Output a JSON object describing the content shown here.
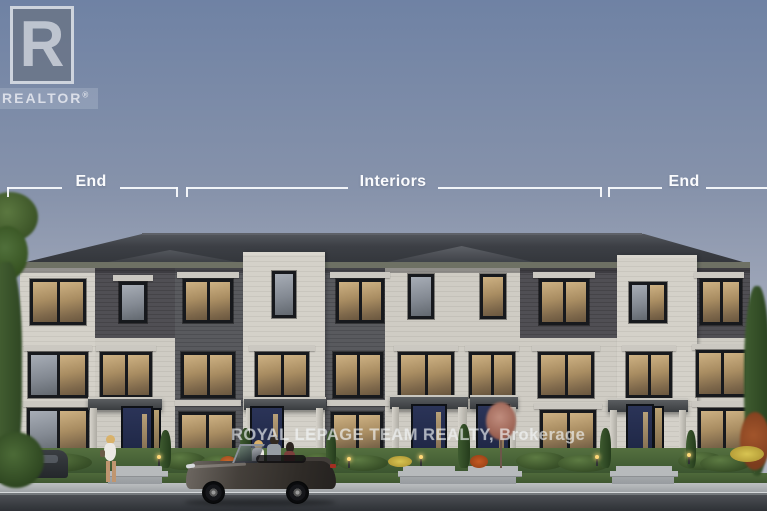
{
  "unit_labels": {
    "left": "End",
    "center": "Interiors",
    "right": "End"
  },
  "watermarks": {
    "realtor_logo": {
      "letter": "R",
      "label": "REALTOR",
      "registered_symbol": "®"
    },
    "brokerage_text": "ROYAL LEPAGE TEAM REALTY, Brokerage"
  },
  "colors": {
    "sky_top": "#6f82a4",
    "sky_bottom": "#b4b8c3",
    "roof": "#3b3e44",
    "fascia": "#6e7164",
    "stone": "#cdcac2",
    "brick": "#54565a",
    "window_frame": "#17191d",
    "window_glow": "#c2a574",
    "door": "#20294a",
    "annotation": "#fafbfd",
    "road": "#3d4045",
    "lawn": "#4c673a"
  }
}
